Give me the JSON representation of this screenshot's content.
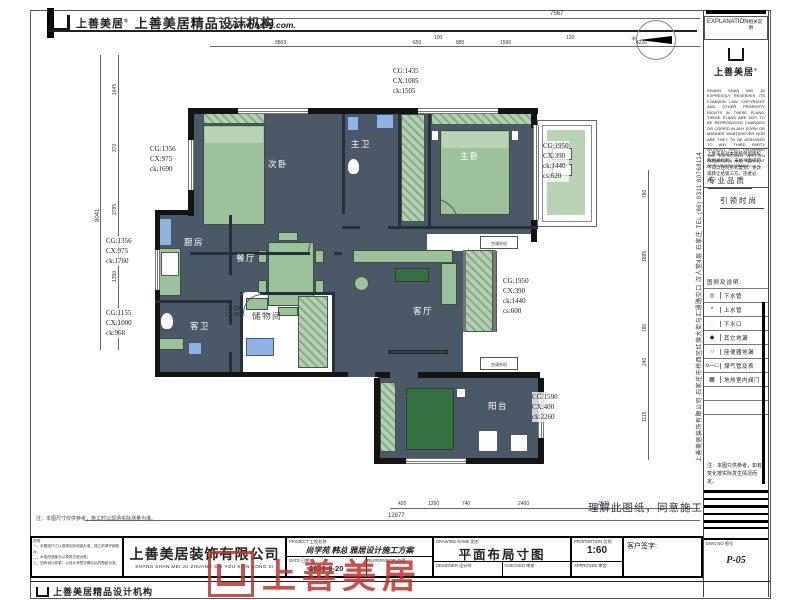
{
  "header": {
    "brand": "上善美居",
    "registered": "®",
    "agency": "上善美居精品设计机构",
    "website": "www.lhs99.com."
  },
  "explanation_panel": {
    "title": "EXPLANATION",
    "subtitle": "相关说明",
    "brand": "上善美居",
    "legal_en": "SHANG SHAN MEI JU EXPRESSLY RESERVES ITS COMMON LAW COPYRIGHT AND OTHER PROPERTY RIGHTS IN THESE PLANS. THESE PLANS ARE NOT TO BE REPRODUCED CHANGED OR COPIED IN ANY FORM OR MANNER WHATSOEVER NOR ARE THEY TO BE ASSIGNED TO ANY THIRD PARTY WITHOUT FIRST OBTAINING THE EXPRESSED WRITTEN PERMISSION AND CONSENT OF SHANGSHANMEIJU.",
    "legal_cn": "上善美居对本图纸保留版权及相关权利，未经书面许可不得以任何形式复制、更改或转让给第三方，违者必究。",
    "slogan_top": "专业品质",
    "slogan_bottom": "引领时尚",
    "legend_title": "图例及说明:",
    "legend": [
      {
        "symbol": "◎",
        "label": "下水管"
      },
      {
        "symbol": "*",
        "label": "上水管"
      },
      {
        "symbol": "·",
        "label": "下水口"
      },
      {
        "symbol": "◆",
        "label": "其它地漏"
      },
      {
        "symbol": "○",
        "label": "座便器地漏"
      },
      {
        "symbol": "o—□",
        "label": "煤气管及表"
      },
      {
        "symbol": "▦",
        "label": "地热室内阀门"
      },
      {
        "symbol": "",
        "label": ""
      },
      {
        "symbol": "",
        "label": ""
      }
    ],
    "note": "注：本图只供参考，如有变化按实际发生情况而定。",
    "dwg_label": "DWG.NO 图号",
    "dwg_no": "P-05"
  },
  "plan": {
    "rooms": [
      "次卧",
      "主卫",
      "主卧",
      "厨房",
      "餐厅",
      "客卫",
      "储物间",
      "客厅",
      "阳台"
    ],
    "window_annotations": [
      [
        "CG:1435",
        "CX:1085",
        "ck:1505"
      ],
      [
        "CG:1356",
        "CX:975",
        "ck:1690"
      ],
      [
        "CG:1356",
        "CX:975",
        "ck:1760"
      ],
      [
        "CG:1155",
        "CX:1000",
        "ck:968"
      ],
      [
        "CG:1950",
        "CX:390",
        "ck:1440",
        "cs:620"
      ],
      [
        "CG:1950",
        "CX:390",
        "ck:1440",
        "cs:600"
      ],
      [
        "CG:1590",
        "CX:400",
        "ck:2260"
      ]
    ],
    "ac_label": "空调外机",
    "storage_note": [
      "LK:200",
      "LS:2475"
    ],
    "consent_text": "理解此图纸，同意施工",
    "address_vertical": "上善美居装饰有限公司 石家庄市桥西区红旗大街与汇通路交口 汉人堂4层 石家庄 TEL (86) 0311 80768114"
  },
  "dimensions": {
    "top_total": "7567",
    "top": [
      "3863",
      "650",
      "100",
      "885",
      "1590",
      "120",
      "4220"
    ],
    "left": [
      "1645",
      "370",
      "2785",
      "1350",
      "960"
    ],
    "left_total": "9041",
    "right": [
      "780",
      "1885",
      "780",
      "240",
      "1115"
    ],
    "bottom": [
      "420",
      "1260",
      "740",
      "2460",
      "2600"
    ],
    "bottom_total": "12877"
  },
  "title_block": {
    "note_above": "注：本图尺寸仅供参考，施工时以现场实际测量为准。",
    "notes": [
      "说明：",
      "一、本图纸尺寸以现场实际测量为准，施工前请仔细核对；",
      "二、水电改造部分以现场交底为准；",
      "三、如有设计变更，以设计师签字确认后的图纸为准。"
    ],
    "company": "上善美居装饰有限公司",
    "company_en": "SHANG SHAN MEI JU ZHUANG SHI YOU XIAN GONG SI",
    "project_label": "PROJECT 工程名称",
    "project": "尚学苑 韩总 雅居设计施工方案",
    "date_label": "DATE 日期",
    "date": "2020-9-20",
    "supervisor_label": "SUPERVISOR 监理",
    "drawing_label": "DRAWING NAME 图名",
    "drawing": "平面布局寸图",
    "designer_label": "DESIGNER 设计师",
    "checked_label": "CHECKED 审核",
    "proportion_label": "PROPORTION 比例",
    "proportion": "1:60",
    "approved_label": "APPROVED 审定",
    "signature_label": "客户签字:",
    "stamp": "上善美居"
  },
  "footer": {
    "agency": "上善美居精品设计机构"
  }
}
